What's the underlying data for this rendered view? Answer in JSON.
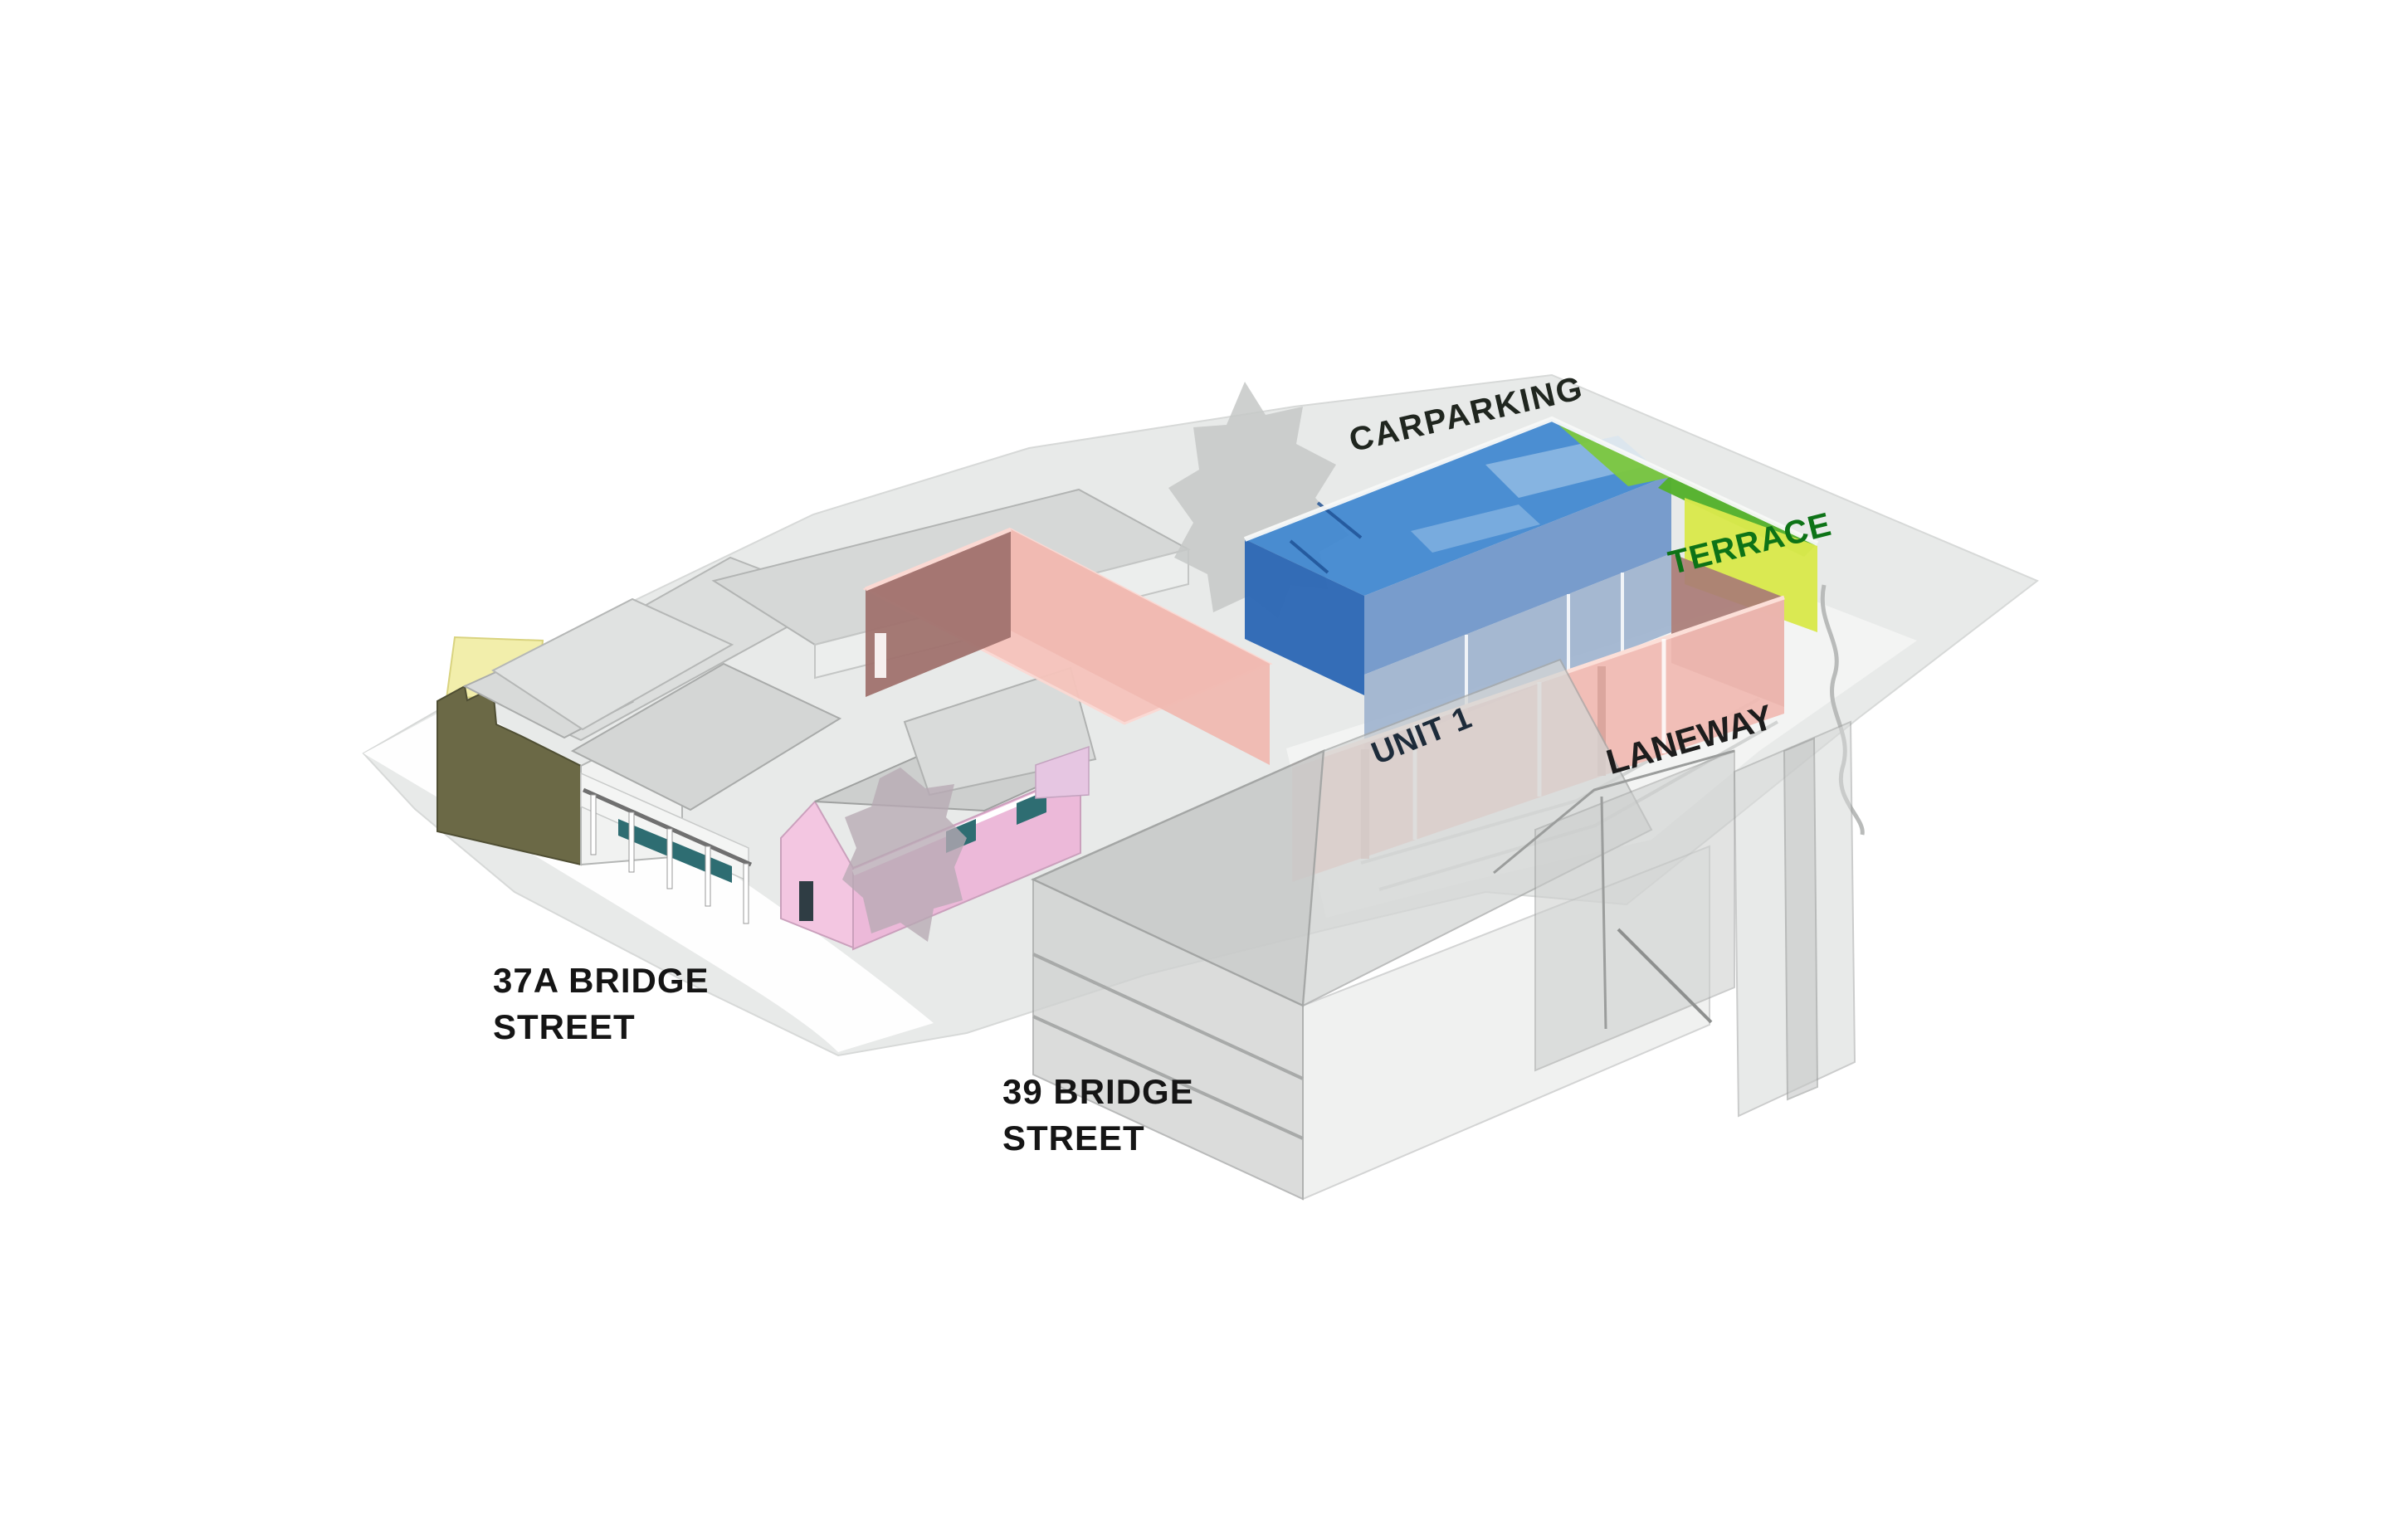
{
  "diagram": {
    "type": "axonometric-site-diagram",
    "labels": {
      "carparking": "CARPARKING",
      "terrace": "TERRACE",
      "unit_1": "UNIT 1",
      "laneway": "LANEWAY",
      "address_37a_line1": "37A BRIDGE",
      "address_37a_line2": "STREET",
      "address_39_line1": "39 BRIDGE",
      "address_39_line2": "STREET"
    },
    "colors": {
      "carpark_blue": "#3e86d0",
      "carpark_blue_dark": "#2a66b4",
      "carpark_blue_skirt": "#6e95c9",
      "carpark_cells_blue": "#9bb1cd",
      "terrace_green": "#54b12b",
      "terrace_lime": "#d9e84c",
      "terrace_label_green": "#0d7317",
      "salmon_wall": "#f0b9b1",
      "salmon_top": "#f6c4bc",
      "salmon_shadow": "#a0726e",
      "salmon_interior": "#a97b76",
      "pink_house": "#f3c6e1",
      "teal_window": "#2e6d72",
      "olive_wall": "#6b6946",
      "yellow_wall": "#f2eeab",
      "ghost_building_gray": "#c9cbca",
      "ground_gray": "#e8eae9",
      "tree_gray": "#c6c8c7",
      "tree_mauve": "#b7a9b4",
      "label_dark": "#1d1d1d",
      "unit_label_navy": "#1d2b3a"
    }
  }
}
